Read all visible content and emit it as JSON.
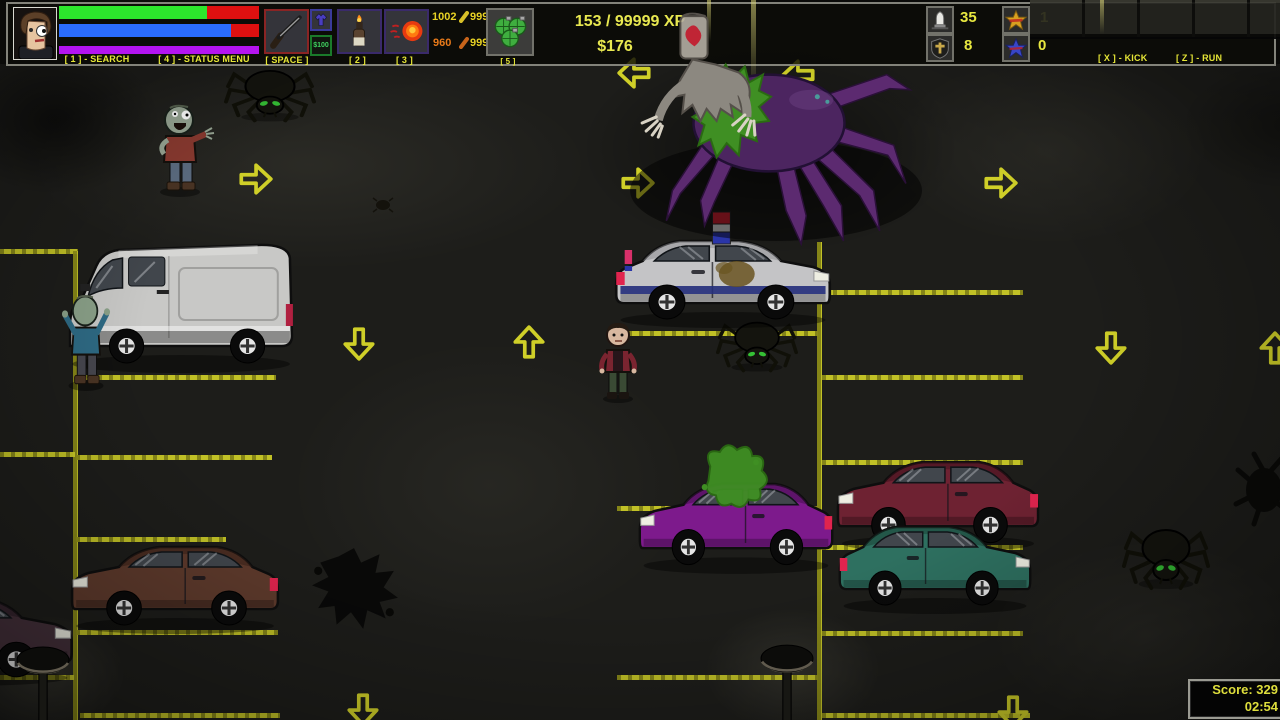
{
  "hud": {
    "search_label": "[ 1 ] - SEARCH",
    "status_label": "[ 4 ] - STATUS MENU",
    "space_label": "[ SPACE ]",
    "slot2_label": "[ 2 ]",
    "slot3_label": "[ 3 ]",
    "slot5_label": "[ 5 ]",
    "money_tag": "$100",
    "xp": "153 / 99999 XP",
    "cash": "$176",
    "kick_label": "[ X ] - KICK",
    "run_label": "[ Z ] - RUN",
    "bar_bg": "#de1010",
    "bars": [
      {
        "name": "health",
        "percent": 74,
        "color": "#2ce62c"
      },
      {
        "name": "stamina",
        "percent": 86,
        "color": "#2a6cff"
      },
      {
        "name": "energy",
        "percent": 100,
        "color": "#b414f0"
      }
    ],
    "ammo": [
      {
        "v": "1002",
        "c": "#e8d224"
      },
      {
        "v": "999",
        "c": "#e8d224"
      },
      {
        "v": "960",
        "c": "#e87a1a"
      },
      {
        "v": "999",
        "c": "#e8d224"
      }
    ],
    "counters": {
      "bullets": "35",
      "medkits": "8",
      "lives": "1",
      "points": "0"
    },
    "icons": {
      "slot1": "shotgun-icon",
      "slot1b": "shirt-icon",
      "slot1c": "money-tag",
      "slot2": "molotov-icon",
      "slot3": "fireball-icon",
      "slot5": "grenades-icon",
      "c1": "bullet-icon",
      "c2": "cross-shield-icon",
      "c3": "gold-star-icon",
      "c4": "blue-star-icon"
    }
  },
  "score": {
    "score": "Score: 329",
    "time": "02:54"
  },
  "scene": {
    "line_color": "#cfcf28",
    "wall": {
      "x": 1030,
      "y": 0,
      "w": 250,
      "h": 37
    },
    "streaks": [
      {
        "x": 707,
        "y": 0,
        "w": 4,
        "h": 42
      },
      {
        "x": 751,
        "y": 0,
        "w": 5,
        "h": 96
      },
      {
        "x": 1100,
        "y": 0,
        "w": 4,
        "h": 34
      }
    ],
    "glows": [
      {
        "x": 30,
        "y": 60,
        "w": 560,
        "h": 210,
        "c": "light",
        "a": 0.07
      },
      {
        "x": 890,
        "y": 55,
        "w": 320,
        "h": 190,
        "c": "light",
        "a": 0.06
      },
      {
        "x": 290,
        "y": 340,
        "w": 400,
        "h": 290,
        "c": "light",
        "a": 0.05
      },
      {
        "x": 990,
        "y": 540,
        "w": 310,
        "h": 190,
        "c": "light",
        "a": 0.05
      },
      {
        "x": -35,
        "y": 615,
        "w": 160,
        "h": 115,
        "c": "light",
        "a": 0.1
      },
      {
        "x": 705,
        "y": 608,
        "w": 175,
        "h": 125,
        "c": "light",
        "a": 0.1
      },
      {
        "x": -50,
        "y": 45,
        "w": 210,
        "h": 150,
        "c": "dark",
        "a": 0.55
      },
      {
        "x": 580,
        "y": 40,
        "w": 380,
        "h": 215,
        "c": "dark",
        "a": 0.5
      },
      {
        "x": 1180,
        "y": 60,
        "w": 220,
        "h": 130,
        "c": "dark",
        "a": 0.35
      }
    ],
    "lines": [
      {
        "x": 0,
        "y": 249,
        "w": 78,
        "h": 5
      },
      {
        "x": 73,
        "y": 251,
        "w": 5,
        "h": 469
      },
      {
        "x": 0,
        "y": 452,
        "w": 75,
        "h": 5
      },
      {
        "x": 0,
        "y": 675,
        "w": 74,
        "h": 5
      },
      {
        "x": 76,
        "y": 375,
        "w": 200,
        "h": 5
      },
      {
        "x": 76,
        "y": 455,
        "w": 196,
        "h": 5
      },
      {
        "x": 76,
        "y": 537,
        "w": 150,
        "h": 5
      },
      {
        "x": 76,
        "y": 630,
        "w": 202,
        "h": 5
      },
      {
        "x": 80,
        "y": 713,
        "w": 200,
        "h": 5
      },
      {
        "x": 817,
        "y": 242,
        "w": 5,
        "h": 478
      },
      {
        "x": 822,
        "y": 290,
        "w": 201,
        "h": 5
      },
      {
        "x": 822,
        "y": 375,
        "w": 201,
        "h": 5
      },
      {
        "x": 822,
        "y": 460,
        "w": 201,
        "h": 5
      },
      {
        "x": 822,
        "y": 545,
        "w": 201,
        "h": 5
      },
      {
        "x": 822,
        "y": 631,
        "w": 201,
        "h": 5
      },
      {
        "x": 822,
        "y": 713,
        "w": 208,
        "h": 5
      },
      {
        "x": 617,
        "y": 331,
        "w": 201,
        "h": 5
      },
      {
        "x": 617,
        "y": 506,
        "w": 201,
        "h": 5
      },
      {
        "x": 617,
        "y": 675,
        "w": 201,
        "h": 5
      }
    ],
    "arrows": [
      {
        "d": "right",
        "x": 236,
        "y": 160
      },
      {
        "d": "left",
        "x": 616,
        "y": 54
      },
      {
        "d": "left",
        "x": 780,
        "y": 56
      },
      {
        "d": "right",
        "x": 618,
        "y": 164
      },
      {
        "d": "right",
        "x": 981,
        "y": 164
      },
      {
        "d": "down",
        "x": 340,
        "y": 324
      },
      {
        "d": "up",
        "x": 510,
        "y": 324
      },
      {
        "d": "down",
        "x": 1092,
        "y": 328
      },
      {
        "d": "up",
        "x": 1256,
        "y": 330
      },
      {
        "d": "down",
        "x": 344,
        "y": 690
      },
      {
        "d": "down",
        "x": 994,
        "y": 692
      }
    ],
    "entities": [
      {
        "t": "splat",
        "n": "black-splat",
        "x": 308,
        "y": 546,
        "w": 92,
        "h": 88,
        "z": 4
      },
      {
        "t": "spiderSplat",
        "n": "spider-splat-right-edge",
        "x": 1234,
        "y": 450,
        "w": 56,
        "h": 78,
        "z": 4
      },
      {
        "t": "bug",
        "n": "dead-bug",
        "x": 372,
        "y": 197,
        "w": 22,
        "h": 16,
        "z": 4
      },
      {
        "t": "van",
        "n": "white-van",
        "x": 60,
        "y": 226,
        "w": 242,
        "h": 152,
        "z": 11,
        "body": "#c8c8c6",
        "shade": "#8e8e8a"
      },
      {
        "t": "police",
        "n": "police-car",
        "x": 612,
        "y": 210,
        "w": 222,
        "h": 120,
        "z": 11,
        "body": "#c4c4c6",
        "shade": "#8a8a8e",
        "flip": true
      },
      {
        "t": "sedan",
        "n": "purple-car",
        "x": 636,
        "y": 452,
        "w": 200,
        "h": 124,
        "z": 11,
        "body": "#7d1a8c",
        "shade": "#3f0d48",
        "splat": true
      },
      {
        "t": "sedan",
        "n": "maroon-car",
        "x": 834,
        "y": 430,
        "w": 208,
        "h": 124,
        "z": 11,
        "body": "#6e2232",
        "shade": "#3c0f1a"
      },
      {
        "t": "sedan",
        "n": "teal-car",
        "x": 836,
        "y": 496,
        "w": 198,
        "h": 120,
        "z": 12,
        "body": "#2e7060",
        "shade": "#173d32",
        "flip": true
      },
      {
        "t": "sedan",
        "n": "brown-car",
        "x": 68,
        "y": 516,
        "w": 214,
        "h": 120,
        "z": 11,
        "body": "#5e3a2c",
        "shade": "#331d16"
      },
      {
        "t": "sedan",
        "n": "corner-car",
        "x": -152,
        "y": 566,
        "w": 228,
        "h": 122,
        "z": 11,
        "body": "#44303a",
        "shade": "#241820",
        "flip": true
      },
      {
        "t": "zombie",
        "n": "zombie-red-shirt",
        "x": 148,
        "y": 98,
        "w": 64,
        "h": 100,
        "z": 12,
        "skin": "#98a694",
        "shirt": "#8a3a30",
        "pants": "#5c6c80",
        "pose": "out"
      },
      {
        "t": "zombie",
        "n": "zombie-at-van",
        "x": 58,
        "y": 288,
        "w": 56,
        "h": 104,
        "z": 12,
        "skin": "#8aa088",
        "shirt": "#2e6a84",
        "pants": "#46464e",
        "pose": "up"
      },
      {
        "t": "player",
        "n": "player-character",
        "x": 594,
        "y": 318,
        "w": 48,
        "h": 86,
        "z": 12,
        "skin": "#d8b8a0",
        "shirt": "#7a2430",
        "pants": "#3a4a34",
        "hair": "#241a12"
      },
      {
        "t": "spider",
        "n": "spider-top-left",
        "x": 224,
        "y": 64,
        "w": 92,
        "h": 60,
        "z": 10
      },
      {
        "t": "spider",
        "n": "spider-under-police-car",
        "x": 716,
        "y": 316,
        "w": 82,
        "h": 58,
        "z": 10
      },
      {
        "t": "spider",
        "n": "spider-bottom-right",
        "x": 1122,
        "y": 522,
        "w": 88,
        "h": 70,
        "z": 10
      },
      {
        "t": "boss",
        "n": "giant-spider-boss",
        "x": 620,
        "y": 4,
        "w": 302,
        "h": 242,
        "z": 21
      },
      {
        "t": "lamp",
        "n": "street-lamp-left",
        "x": 16,
        "y": 642,
        "w": 54,
        "h": 80,
        "z": 16
      },
      {
        "t": "lamp",
        "n": "street-lamp-center",
        "x": 760,
        "y": 640,
        "w": 54,
        "h": 82,
        "z": 16
      }
    ]
  }
}
